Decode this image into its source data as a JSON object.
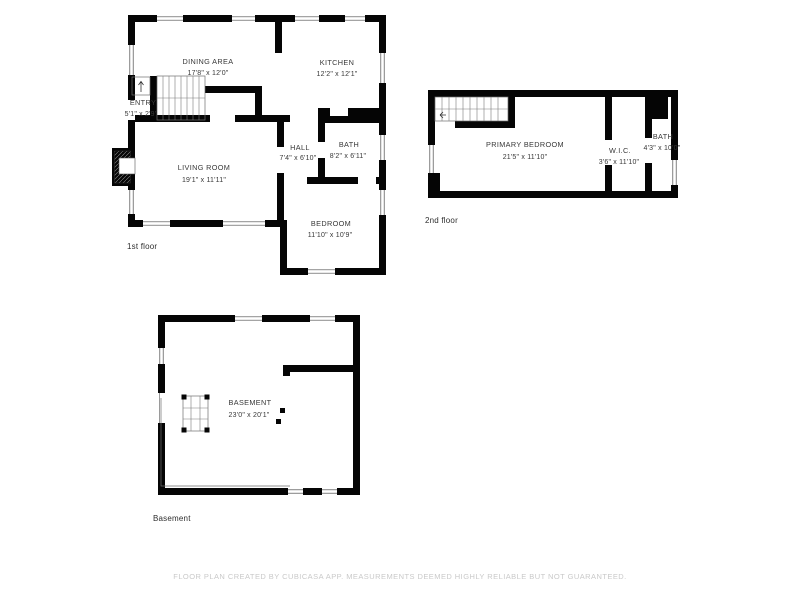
{
  "footer": {
    "disclaimer": "FLOOR PLAN CREATED BY CUBICASA APP. MEASUREMENTS DEEMED HIGHLY RELIABLE BUT NOT GUARANTEED."
  },
  "floors": [
    {
      "label": "1st floor",
      "rooms": [
        {
          "name": "DINING AREA",
          "dims": "17'8\" x 12'0\""
        },
        {
          "name": "KITCHEN",
          "dims": "12'2\" x 12'1\""
        },
        {
          "name": "ENTRY",
          "dims": "5'1\" x 2'9\""
        },
        {
          "name": "LIVING ROOM",
          "dims": "19'1\" x 11'11\""
        },
        {
          "name": "HALL",
          "dims": "7'4\" x 6'10\""
        },
        {
          "name": "BATH",
          "dims": "8'2\" x 6'11\""
        },
        {
          "name": "BEDROOM",
          "dims": "11'10\" x 10'9\""
        }
      ]
    },
    {
      "label": "2nd floor",
      "rooms": [
        {
          "name": "PRIMARY BEDROOM",
          "dims": "21'5\" x 11'10\""
        },
        {
          "name": "W.I.C.",
          "dims": "3'6\" x 11'10\""
        },
        {
          "name": "BATH",
          "dims": "4'3\" x 10'0\""
        }
      ]
    },
    {
      "label": "Basement",
      "rooms": [
        {
          "name": "BASEMENT",
          "dims": "23'0\" x 20'1\""
        }
      ]
    }
  ],
  "colors": {
    "wall": "#050505",
    "room_text": "#383838",
    "floor_label_text": "#2e2e2e",
    "disclaimer_text": "#c9c9c9",
    "background": "#ffffff"
  }
}
